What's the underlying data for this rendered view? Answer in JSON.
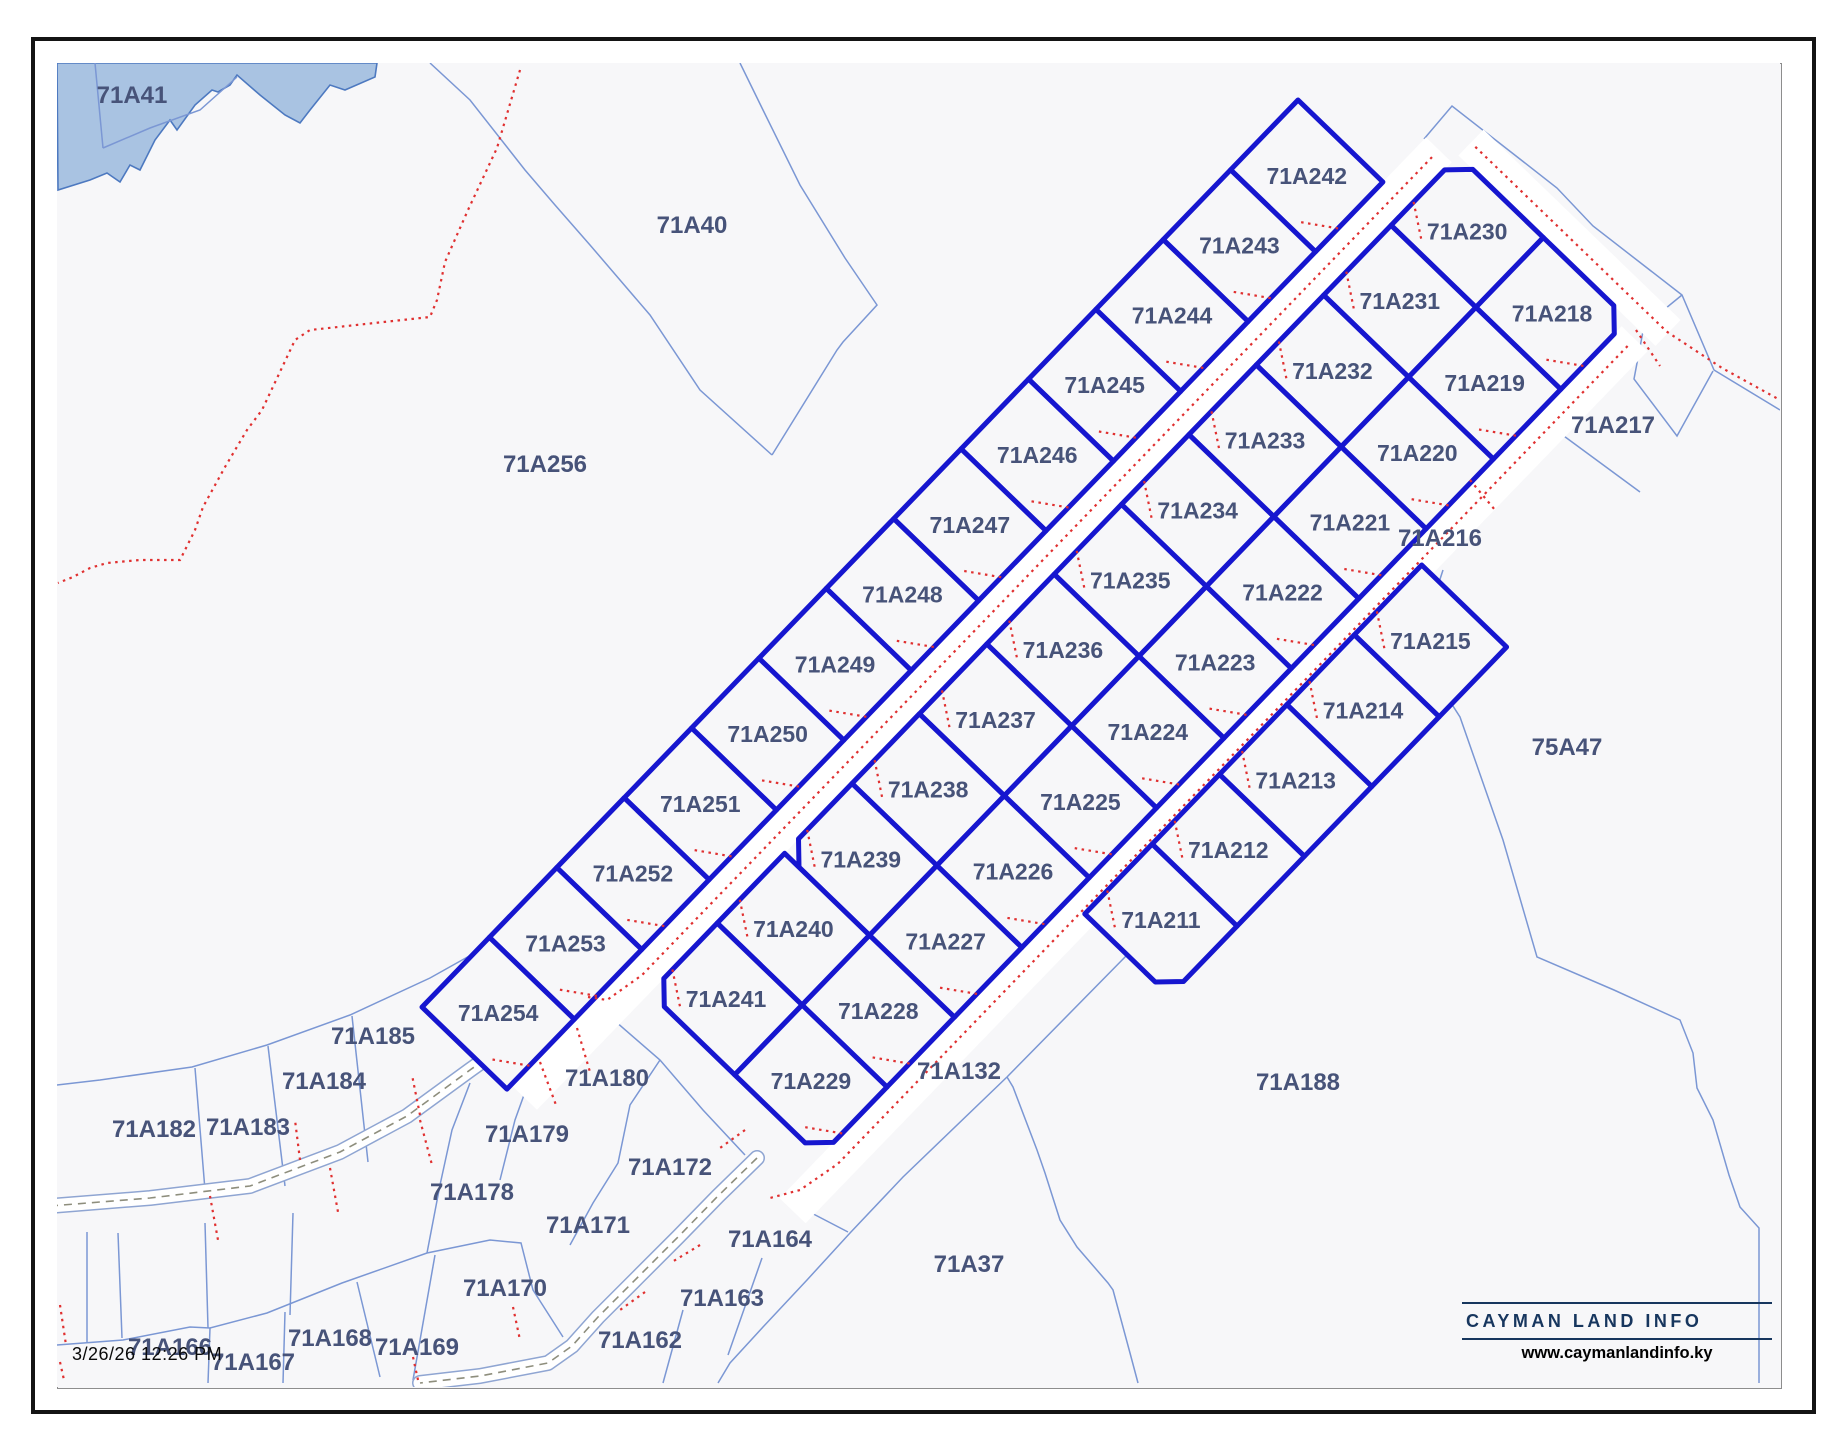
{
  "timestamp": "3/26/26 12:26 PM",
  "logo": {
    "name": "CAYMAN LAND INFO",
    "url": "www.caymanlandinfo.ky"
  },
  "colors": {
    "background": "#f7f7f9",
    "bold_parcel": "#1616cf",
    "thin_line": "#7b97d4",
    "water_fill": "#a9c3e2",
    "water_edge": "#4d79c0",
    "red_dots": "#e03030",
    "road_casing": "#8fa5d2",
    "road_dash": "#8e8e7d",
    "label_text": "#475379"
  },
  "subdivision": {
    "left_strip": [
      "71A242",
      "71A243",
      "71A244",
      "71A245",
      "71A246",
      "71A247",
      "71A248",
      "71A249",
      "71A250",
      "71A251",
      "71A252",
      "71A253",
      "71A254"
    ],
    "nw_column": [
      "71A230",
      "71A231",
      "71A232",
      "71A233",
      "71A234",
      "71A235",
      "71A236",
      "71A237",
      "71A238",
      "71A239",
      "71A240",
      "71A241"
    ],
    "se_column": [
      "71A218",
      "71A219",
      "71A220",
      "71A221",
      "71A222",
      "71A223",
      "71A224",
      "71A225",
      "71A226",
      "71A227",
      "71A228",
      "71A229"
    ],
    "right_strip": [
      "71A215",
      "71A214",
      "71A213",
      "71A212",
      "71A211"
    ]
  },
  "outer_parcels": [
    {
      "label": "71A41",
      "x": 132,
      "y": 95
    },
    {
      "label": "71A40",
      "x": 692,
      "y": 225
    },
    {
      "label": "71A256",
      "x": 545,
      "y": 464
    },
    {
      "label": "71A217",
      "x": 1613,
      "y": 425
    },
    {
      "label": "71A216",
      "x": 1440,
      "y": 538
    },
    {
      "label": "75A47",
      "x": 1567,
      "y": 747
    },
    {
      "label": "71A188",
      "x": 1298,
      "y": 1082
    },
    {
      "label": "71A132",
      "x": 959,
      "y": 1071
    },
    {
      "label": "71A37",
      "x": 969,
      "y": 1264
    },
    {
      "label": "71A185",
      "x": 373,
      "y": 1036
    },
    {
      "label": "71A184",
      "x": 324,
      "y": 1081
    },
    {
      "label": "71A183",
      "x": 248,
      "y": 1127
    },
    {
      "label": "71A182",
      "x": 154,
      "y": 1129
    },
    {
      "label": "71A180",
      "x": 607,
      "y": 1078
    },
    {
      "label": "71A179",
      "x": 527,
      "y": 1134
    },
    {
      "label": "71A178",
      "x": 472,
      "y": 1192
    },
    {
      "label": "71A172",
      "x": 670,
      "y": 1167
    },
    {
      "label": "71A171",
      "x": 588,
      "y": 1225
    },
    {
      "label": "71A170",
      "x": 505,
      "y": 1288
    },
    {
      "label": "71A164",
      "x": 770,
      "y": 1239
    },
    {
      "label": "71A163",
      "x": 722,
      "y": 1298
    },
    {
      "label": "71A162",
      "x": 640,
      "y": 1340
    },
    {
      "label": "71A166",
      "x": 170,
      "y": 1347
    },
    {
      "label": "71A167",
      "x": 253,
      "y": 1362
    },
    {
      "label": "71A168",
      "x": 330,
      "y": 1338
    },
    {
      "label": "71A169",
      "x": 417,
      "y": 1347
    }
  ]
}
